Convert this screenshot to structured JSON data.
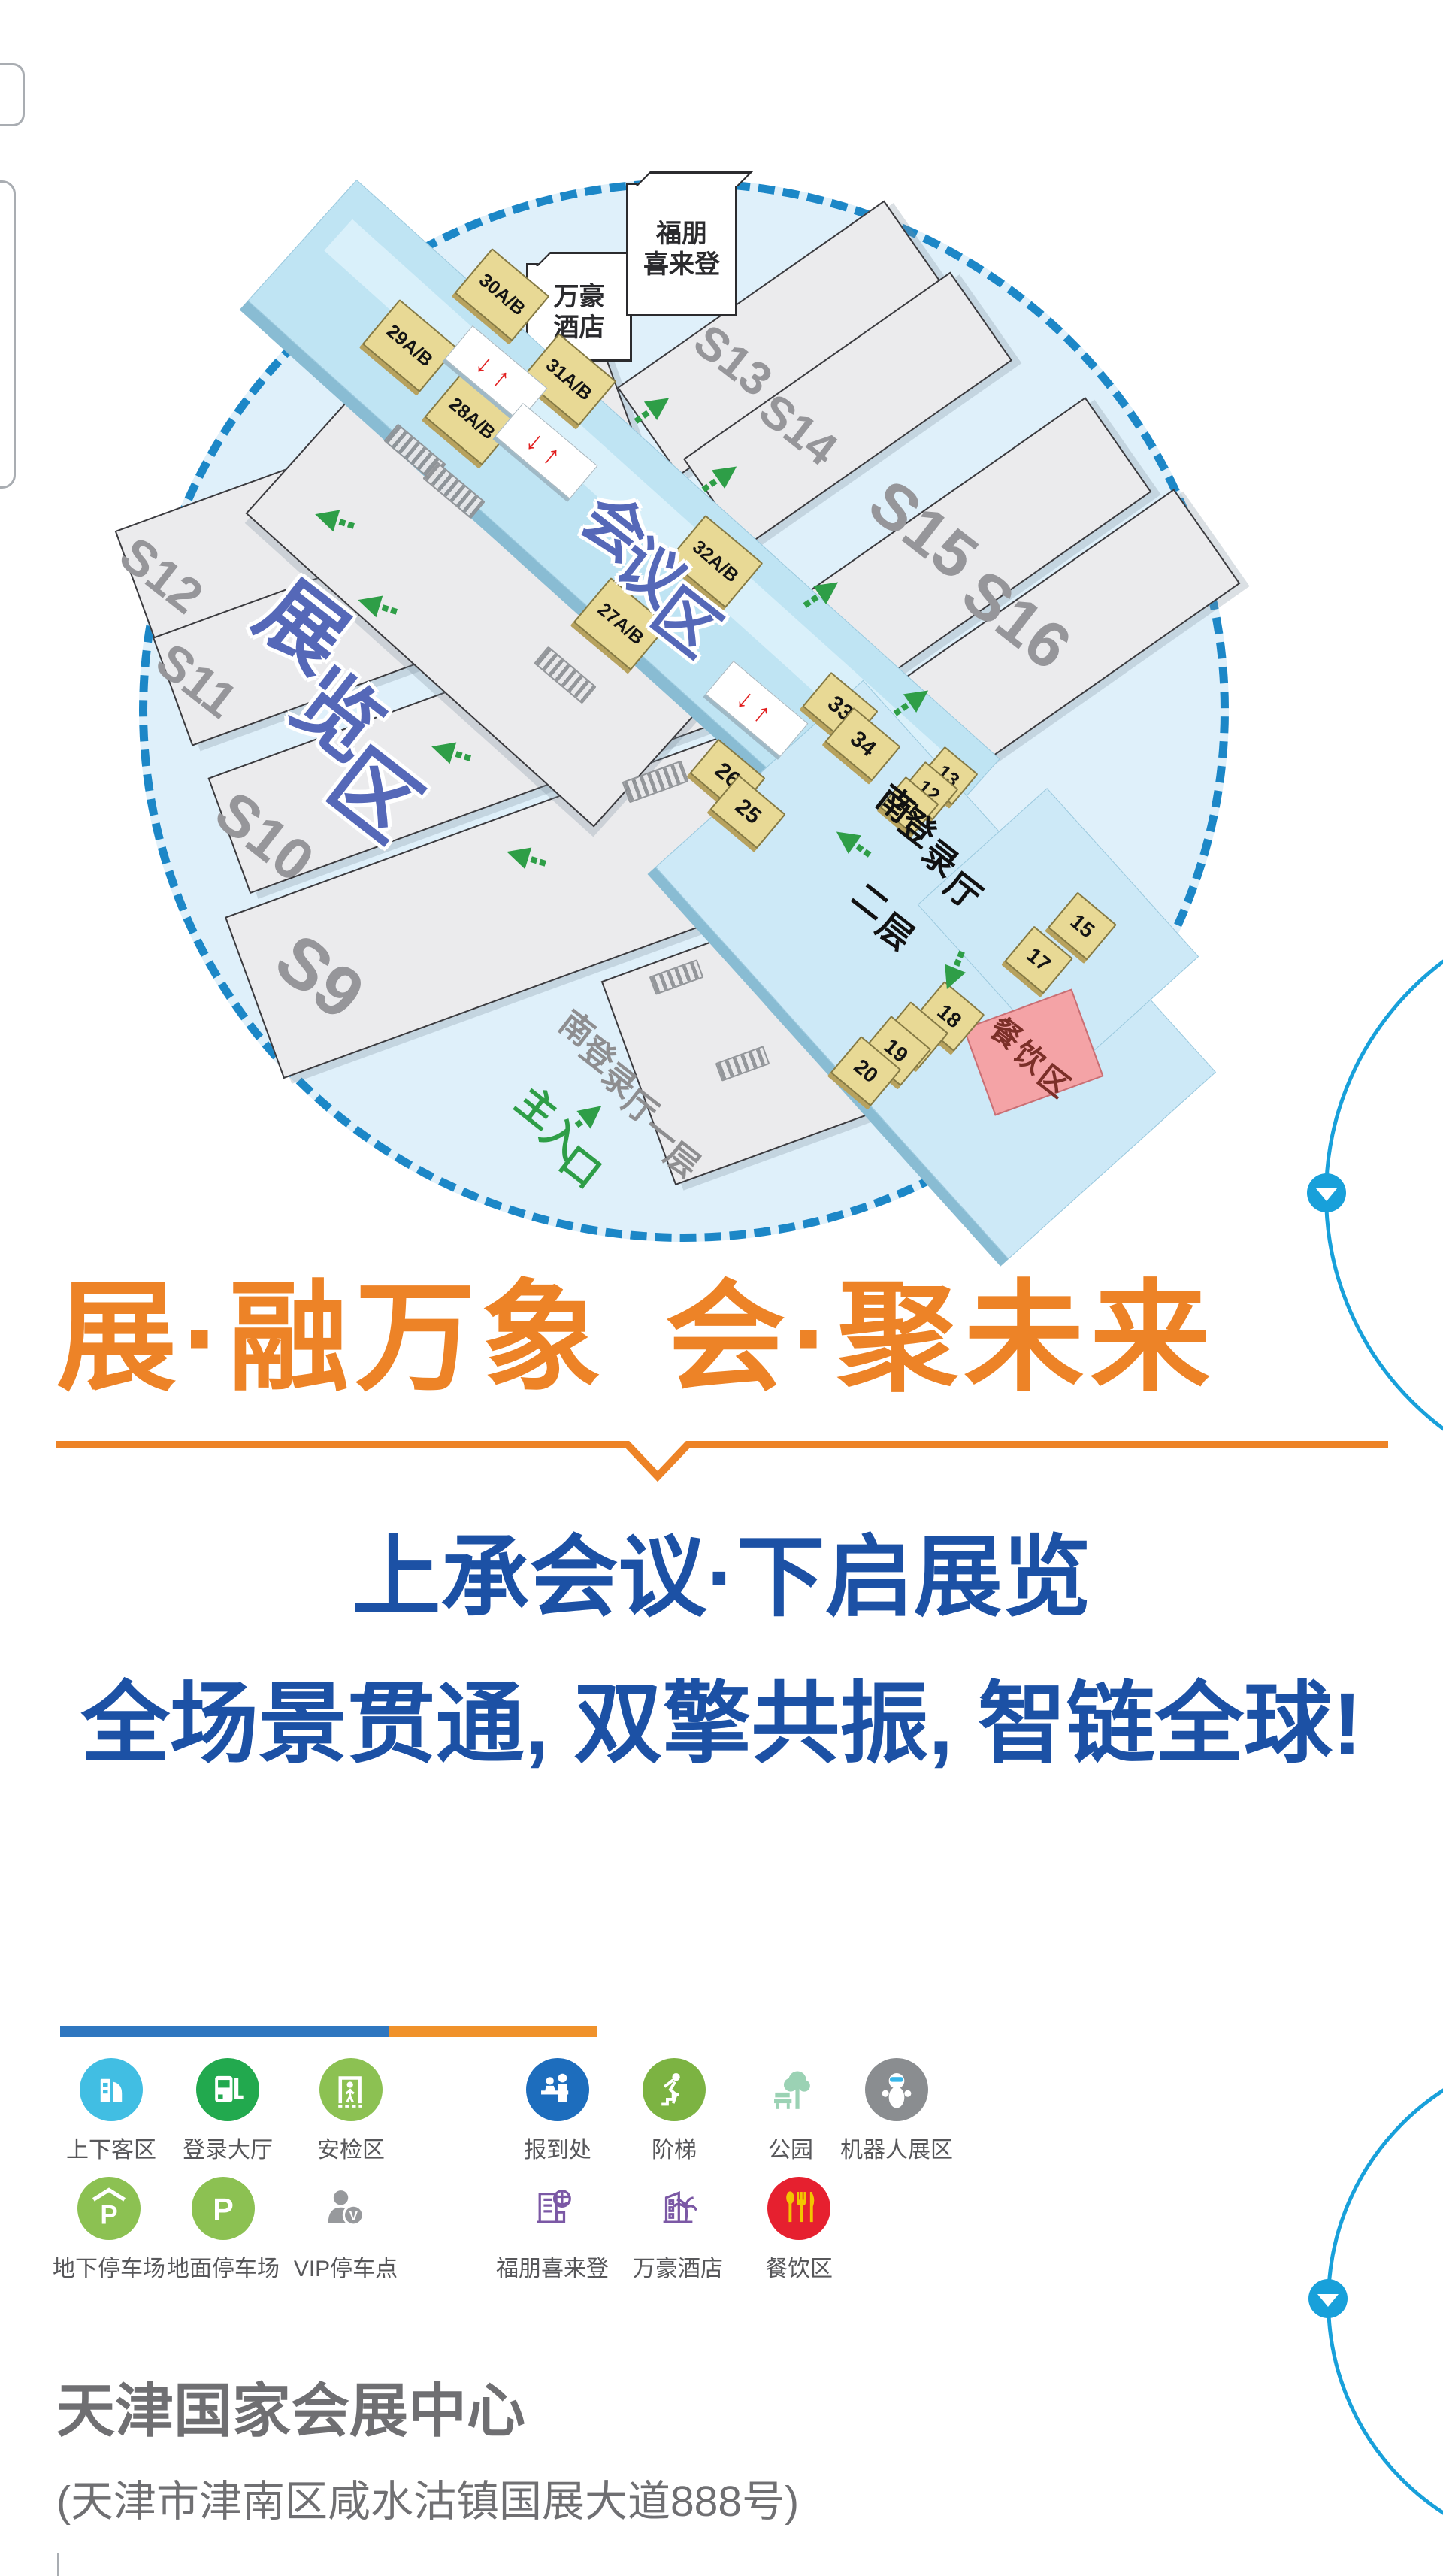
{
  "map": {
    "halls": [
      "S12",
      "S11",
      "S10",
      "S9",
      "S13",
      "S14",
      "S15",
      "S16"
    ],
    "rooms": [
      "29A/B",
      "30A/B",
      "28A/B",
      "31A/B",
      "27A/B",
      "32A/B",
      "33",
      "34",
      "26",
      "25",
      "13",
      "12",
      "11",
      "15",
      "17",
      "18",
      "19",
      "20"
    ],
    "hotels": {
      "marriott": [
        "万豪",
        "酒店"
      ],
      "four_points": [
        "福朋",
        "喜来登"
      ]
    },
    "chars": {
      "exhibition": [
        "展",
        "览",
        "区"
      ],
      "conference": [
        "会",
        "议",
        "区"
      ],
      "south_hall_l2": [
        "南",
        "登",
        "录",
        "厅"
      ],
      "south_hall_l2_floor": [
        "二",
        "层"
      ],
      "south_hall_l1": [
        "南",
        "登",
        "录",
        "厅",
        "一",
        "层"
      ],
      "main_entrance": [
        "主",
        "入",
        "口"
      ],
      "dining": [
        "餐",
        "饮",
        "区"
      ]
    },
    "escalator_arrows": "↓↑"
  },
  "headline": {
    "left": "展·融万象",
    "right": "会·聚未来"
  },
  "tagline": {
    "line1": "上承会议·下启展览",
    "line2": "全场景贯通, 双擎共振, 智链全球!"
  },
  "legend": {
    "row1": [
      {
        "icon": "passenger-dropoff-icon",
        "label": "上下客区"
      },
      {
        "icon": "login-hall-icon",
        "label": "登录大厅"
      },
      {
        "icon": "security-check-icon",
        "label": "安检区"
      },
      {
        "icon": "registration-icon",
        "label": "报到处"
      },
      {
        "icon": "stairs-icon",
        "label": "阶梯"
      },
      {
        "icon": "park-icon",
        "label": "公园"
      },
      {
        "icon": "robot-zone-icon",
        "label": "机器人展区"
      }
    ],
    "row2": [
      {
        "icon": "underground-parking-icon",
        "label": "地下停车场"
      },
      {
        "icon": "ground-parking-icon",
        "label": "地面停车场"
      },
      {
        "icon": "vip-parking-icon",
        "label": "VIP停车点"
      },
      {
        "icon": "four-points-hotel-icon",
        "label": "福朋喜来登"
      },
      {
        "icon": "marriott-hotel-icon",
        "label": "万豪酒店"
      },
      {
        "icon": "dining-icon",
        "label": "餐饮区"
      }
    ]
  },
  "footer": {
    "venue_name": "天津国家会展中心",
    "address": "(天津市津南区咸水沽镇国展大道888号)"
  },
  "colors": {
    "accent_orange": "#ED8327",
    "deep_blue": "#1C51A5",
    "map_circle_blue": "#1C87C7",
    "walkway_blue": "#BFE4F3",
    "room_yellow": "#E8D995",
    "direction_green": "#2E9E47",
    "dining_pink": "#F4A3A6",
    "scroll_blue": "#18A0DA"
  }
}
